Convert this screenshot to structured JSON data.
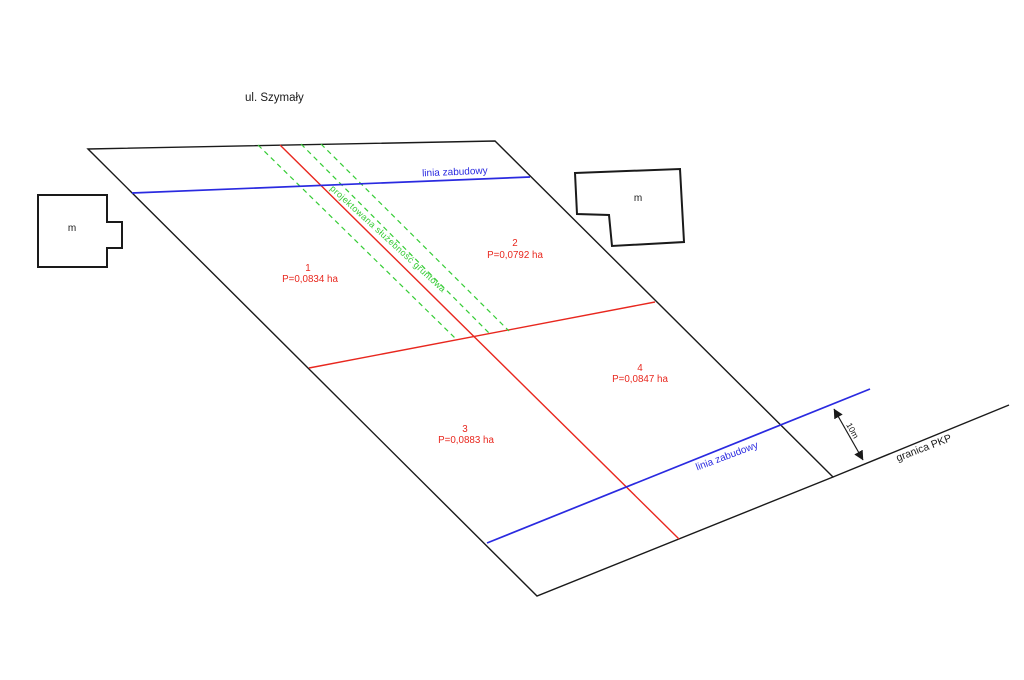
{
  "plan": {
    "street_label": "ul. Szymały"
  },
  "colors": {
    "boundary": "#1a1a1a",
    "division": "#e8271e",
    "building_line": "#2a2ae0",
    "easement": "#35cc35"
  },
  "parcels": [
    {
      "number": "1",
      "area_label": "P=0,0834 ha"
    },
    {
      "number": "2",
      "area_label": "P=0,0792 ha"
    },
    {
      "number": "3",
      "area_label": "P=0,0883 ha"
    },
    {
      "number": "4",
      "area_label": "P=0,0847 ha"
    }
  ],
  "annotations": {
    "building_line_upper_label": "linia zabudowy",
    "building_line_lower_label": "linia zabudowy",
    "easement_label": "projektowana służebność gruntowa",
    "railway_boundary_label": "granica PKP",
    "dimension_label": "10m",
    "building_marker_left": "m",
    "building_marker_right": "m"
  }
}
